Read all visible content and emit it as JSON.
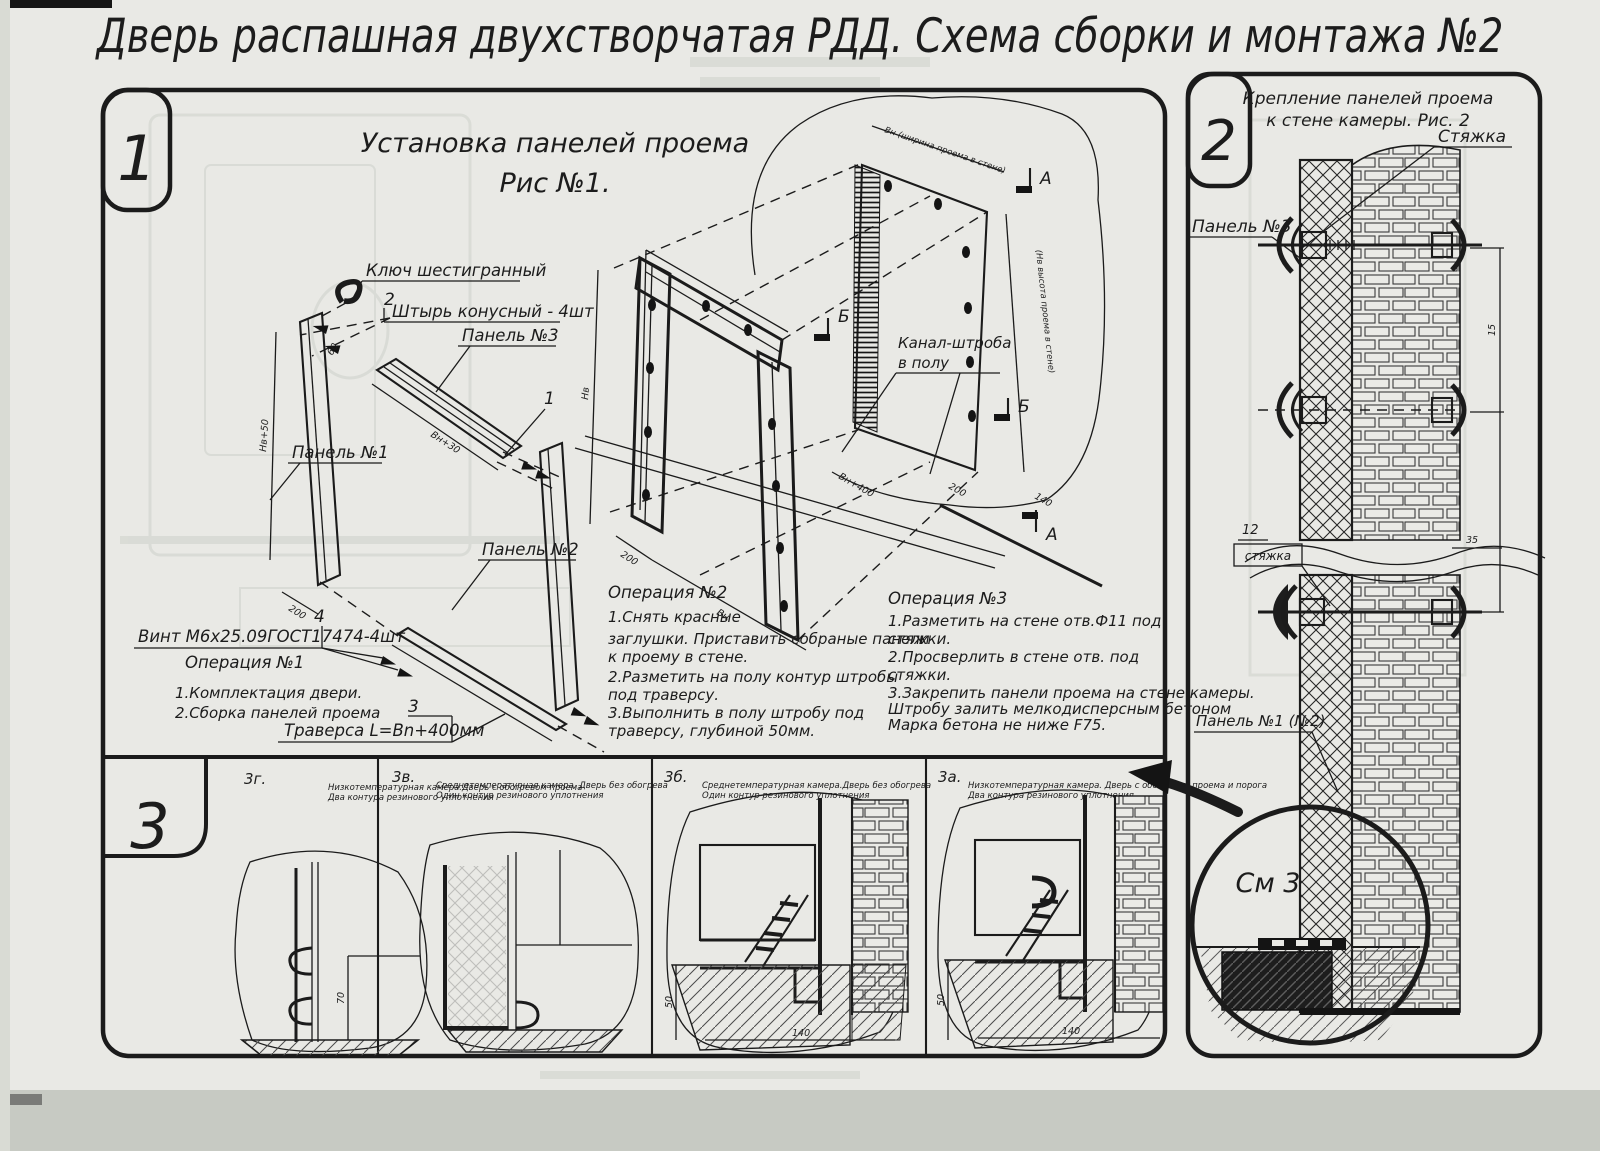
{
  "t": "Дверь распашная двухстворчатая РДД.  Схема сборки и монтажа №2",
  "s1": {
    "num": "1",
    "t1": "Установка панелей проема",
    "t2": "Рис №1.",
    "lab": {
      "kluch": "Ключ шестигранный",
      "n2": "2",
      "pin": "Штырь конусный - 4шт",
      "p3": "Панель №3",
      "n1": "1",
      "p1": "Панель №1",
      "p2": "Панель №2",
      "n4": "4",
      "vint": "Винт М6х25.09ГОСТ17474-4шт",
      "n3": "3",
      "trav": "Траверса  L=Bn+400мм",
      "kanal1": "Канал-штроба",
      "kanal2": "в полу",
      "mA": "А",
      "mB": "Б"
    },
    "op1": {
      "h": "Операция №1",
      "l": [
        "1.Комплектация двери.",
        "2.Сборка панелей проема"
      ]
    },
    "op2": {
      "h": "Операция №2",
      "l": [
        "1.Снять красные",
        "заглушки. Приставить собраные панели",
        "к проему в стене.",
        "2.Разметить на полу контур штробы",
        "под траверсу.",
        "3.Выполнить в полу штробу под",
        "траверсу, глубиной 50мм."
      ]
    },
    "op3": {
      "h": "Операция №3",
      "l": [
        "1.Разметить на стене отв.Ф11 под",
        "стяжки.",
        "2.Просверлить в стене отв.   под",
        "стяжки.",
        "3.Закрепить панели проема на стене камеры.",
        "Штробу залить мелкодисперсным бетоном",
        "Марка бетона не ниже   F75."
      ]
    },
    "dims": {
      "nv50": "Нв+50",
      "d200": "200",
      "vn30": "Вн+30",
      "d60": "60",
      "nv": "Нв",
      "vn": "Вн",
      "vn400": "Вн+400",
      "d140": "140",
      "wnote": "Вн (ширина проема в стене)",
      "hnote": "(Нв высота проема в стене)"
    }
  },
  "s2": {
    "num": "2",
    "t1": "Крепление панелей проема",
    "t2": "к стене камеры. Рис. 2",
    "tie": "Стяжка",
    "p3": "Панель №3",
    "n12": "12",
    "tie2": "стяжка",
    "p12": "Панель №1 (№2)",
    "see": "См 3",
    "d15": "15",
    "d35": "35"
  },
  "s3": {
    "num": "3",
    "d70": "70",
    "d50": "50",
    "d140": "140",
    "p": [
      {
        "id": "3г.",
        "c1": "Низкотемпературная камера.Дверь с обогревом проема",
        "c2": "Два контура резинового уплотнения"
      },
      {
        "id": "3в.",
        "c1": "Среднетемпературная камера. Дверь без обогрева",
        "c2": "Один контур резинового уплотнения"
      },
      {
        "id": "3б.",
        "c1": "Среднетемпературная камера.Дверь без обогрева",
        "c2": "Один контур резинового уплотнения"
      },
      {
        "id": "3а.",
        "c1": "Низкотемпературная камера. Дверь с обогревом проема и порога",
        "c2": "Два контура резинового уплотнения"
      }
    ]
  }
}
